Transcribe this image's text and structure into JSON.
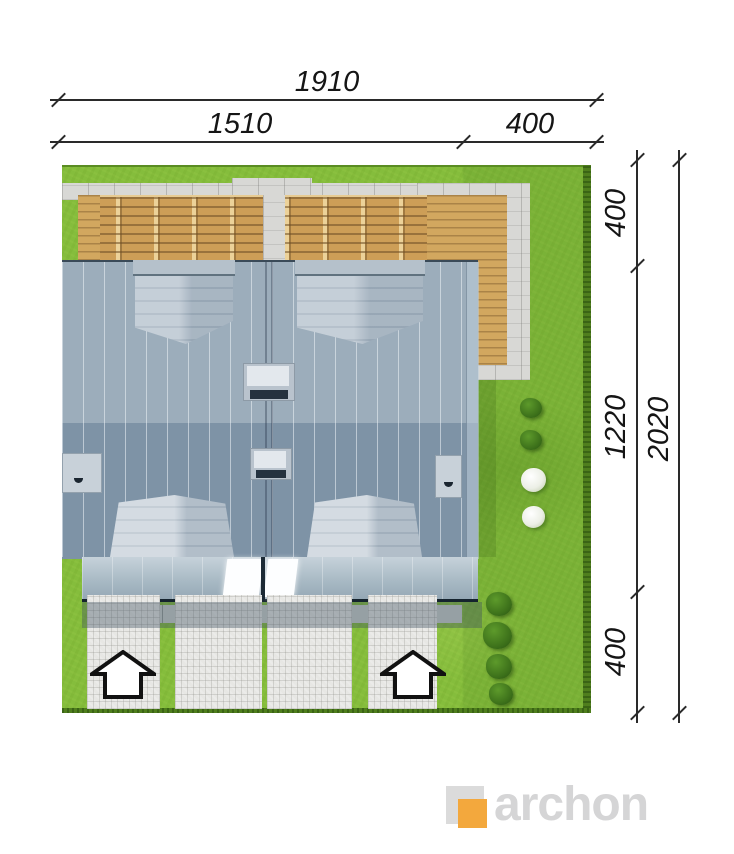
{
  "dimensions": {
    "top": {
      "total": "1910",
      "main": "1510",
      "side": "400"
    },
    "right": {
      "top": "400",
      "middle": "1220",
      "bottom": "400",
      "total": "2020"
    }
  },
  "logo": {
    "text": "archon",
    "orange_color": "#f3a83d",
    "gray_color": "#d5d5d6"
  },
  "plan_colors": {
    "grass": "#85bd3c",
    "roof_upper_slope": "#9cadbb",
    "roof_lower_slope": "#7e93a6",
    "wood_terrace": "#cd9e57",
    "concrete_border": "#d8d8d5",
    "paving": "#e7e7e4",
    "dimension_lines": "#2a2a2a"
  }
}
